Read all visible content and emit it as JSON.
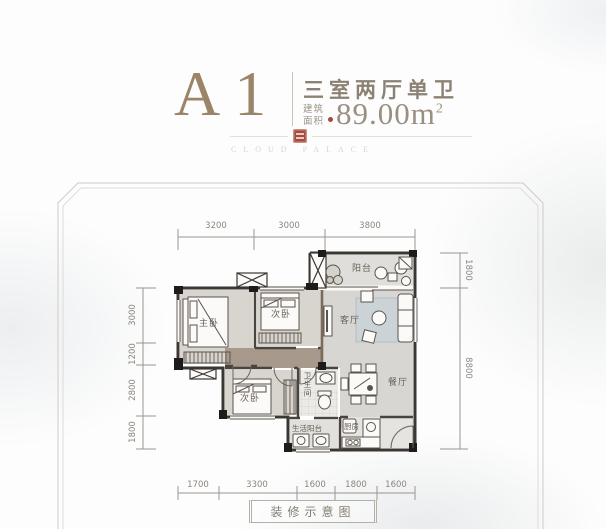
{
  "header": {
    "unit_name": "A1",
    "layout_type": "三室两厅单卫",
    "area_label": "建筑面积",
    "area_value": "89.00m",
    "area_exponent": "2"
  },
  "watermark": {
    "text": "CLOUD PALACE"
  },
  "theme": {
    "accent_gold": "#9c8468",
    "seal_red": "#a5483e",
    "wall_dark": "#3b3733",
    "corridor_brown": "#a79a8c"
  },
  "plan": {
    "rooms": {
      "balcony": "阳台",
      "living": "客厅",
      "master": "主卧",
      "bedroom2": "次卧",
      "bedroom3": "次卧",
      "bathroom": "卫生间",
      "dining": "餐厅",
      "kitchen": "厨房",
      "utility": "生活阳台"
    },
    "dimensions": {
      "top": [
        "3200",
        "3000",
        "3800"
      ],
      "bottom": [
        "1700",
        "3300",
        "1600",
        "1800",
        "1600"
      ],
      "left": [
        "3000",
        "1200",
        "2800",
        "1800"
      ],
      "right": [
        "1800",
        "8800"
      ]
    }
  },
  "footer": {
    "label": "装修示意图"
  }
}
